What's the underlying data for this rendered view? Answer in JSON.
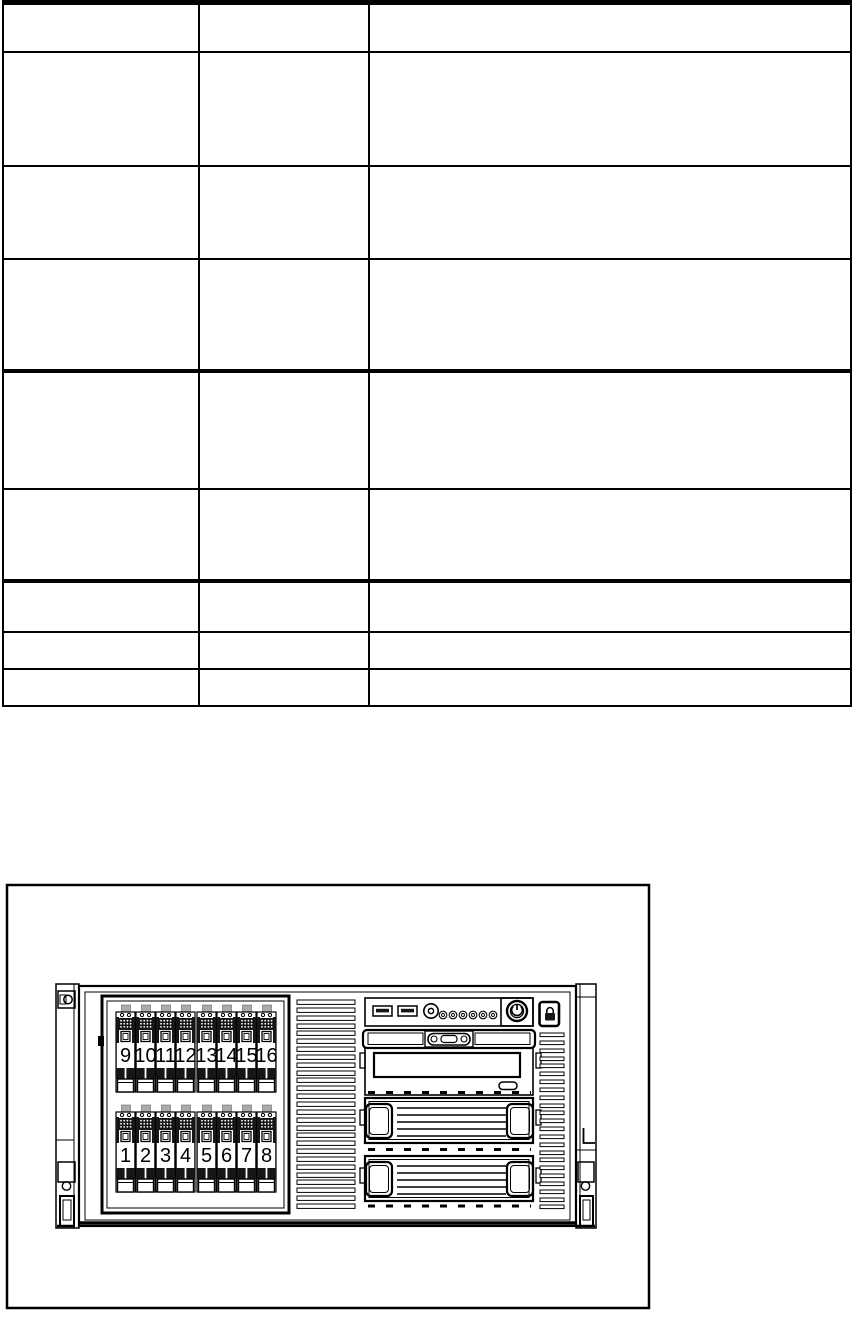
{
  "page": {
    "background": "#ffffff",
    "line_color": "#000000"
  },
  "table": {
    "columns": 3,
    "rows": 9,
    "cells": [
      [
        "",
        "",
        ""
      ],
      [
        "",
        "",
        ""
      ],
      [
        "",
        "",
        ""
      ],
      [
        "",
        "",
        ""
      ],
      [
        "",
        "",
        ""
      ],
      [
        "",
        "",
        ""
      ],
      [
        "",
        "",
        ""
      ],
      [
        "",
        "",
        ""
      ],
      [
        "",
        "",
        ""
      ]
    ]
  },
  "figure": {
    "type": "server-front-panel-line-drawing",
    "drive_bays": {
      "top_row": [
        "9",
        "10",
        "11",
        "12",
        "13",
        "14",
        "15",
        "16"
      ],
      "bottom_row": [
        "1",
        "2",
        "3",
        "4",
        "5",
        "6",
        "7",
        "8"
      ]
    },
    "status_led_count": 6,
    "usb_port_count": 2,
    "components": [
      "left-rack-ear",
      "hot-swap-drive-cage",
      "middle-vent-grille",
      "usb-ports",
      "round-connector",
      "status-leds",
      "power-button",
      "lock-button",
      "vga-connector-panel",
      "optical-drive-bay",
      "eject-button",
      "device-bay-upper",
      "device-bay-lower",
      "right-vent-grille",
      "right-rack-ear"
    ],
    "colors": {
      "line": "#000000",
      "tray_dark": "#161616",
      "background": "#ffffff"
    }
  }
}
